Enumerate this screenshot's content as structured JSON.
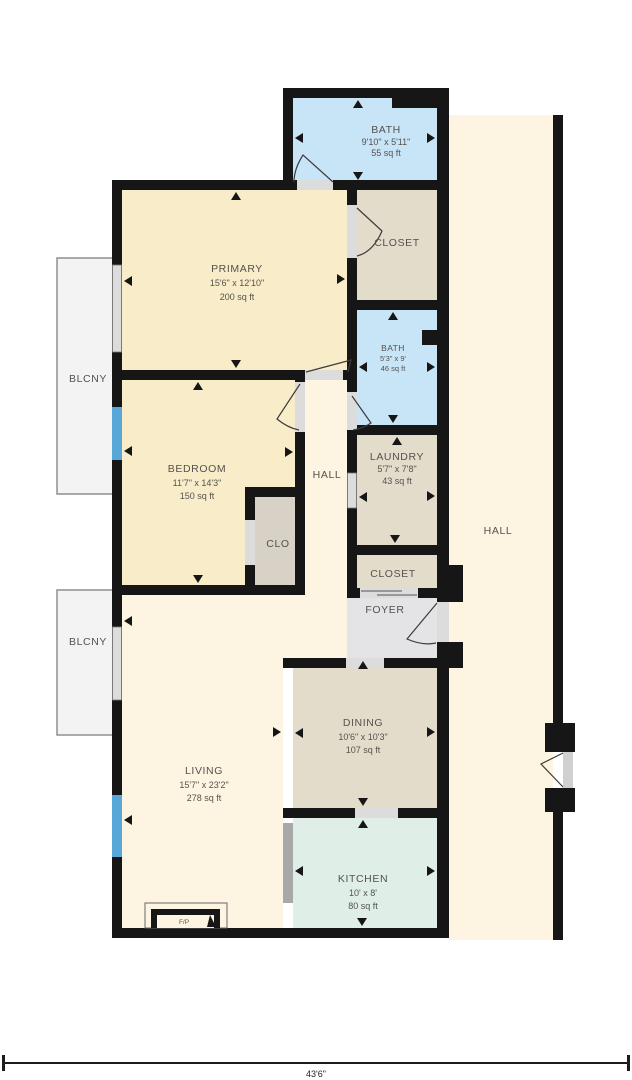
{
  "colors": {
    "wall": "#161616",
    "cream_dark": "#f8ecc9",
    "cream_light": "#fdf5e1",
    "tan": "#e4dccb",
    "clo_gray": "#d7d1c6",
    "bath_blue": "#c8e4f7",
    "kitchen_mint": "#dfeee6",
    "foyer_gray": "#e4e4e6",
    "balcony_gray": "#f3f3f3",
    "window_blue": "#57a8d8",
    "opening_gray": "#dcdcdc",
    "doorway_gray": "#a8a8a8"
  },
  "rooms": {
    "bath_top": {
      "name": "BATH",
      "dims": "9'10\" x 5'11\"",
      "area": "55 sq ft"
    },
    "closet_primary": {
      "name": "CLOSET"
    },
    "primary": {
      "name": "PRIMARY",
      "dims": "15'6\" x 12'10\"",
      "area": "200 sq ft"
    },
    "bath_hall": {
      "name": "BATH",
      "dims": "5'3\" x 9'",
      "area": "46 sq ft"
    },
    "bedroom": {
      "name": "BEDROOM",
      "dims": "11'7\" x 14'3\"",
      "area": "150 sq ft"
    },
    "hall_center": {
      "name": "HALL"
    },
    "laundry": {
      "name": "LAUNDRY",
      "dims": "5'7\" x 7'8\"",
      "area": "43 sq ft"
    },
    "clo": {
      "name": "CLO"
    },
    "closet_entry": {
      "name": "CLOSET"
    },
    "foyer": {
      "name": "FOYER"
    },
    "hall_right": {
      "name": "HALL"
    },
    "balcony_upper": {
      "name": "BLCNY"
    },
    "balcony_lower": {
      "name": "BLCNY"
    },
    "dining": {
      "name": "DINING",
      "dims": "10'6\" x 10'3\"",
      "area": "107 sq ft"
    },
    "living": {
      "name": "LIVING",
      "dims": "15'7\" x 23'2\"",
      "area": "278 sq ft"
    },
    "kitchen": {
      "name": "KITCHEN",
      "dims": "10' x 8'",
      "area": "80 sq ft"
    },
    "fireplace": {
      "name": "F/P"
    }
  },
  "dimension": {
    "overall_width": "43'6\""
  }
}
